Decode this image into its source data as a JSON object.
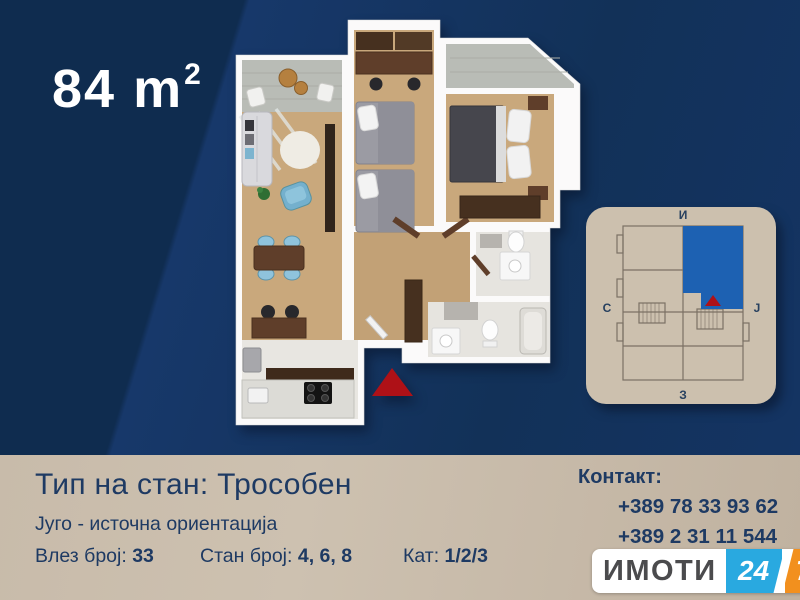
{
  "hero": {
    "area_value": "84",
    "area_unit": "m",
    "area_sup": "2"
  },
  "minimap": {
    "compass": {
      "top": "И",
      "left": "С",
      "right": "Ј",
      "bottom": "З"
    },
    "highlight_color": "#1d61b2",
    "marker_color": "#ae1117"
  },
  "floorplan": {
    "entrance_marker_color": "#ae1117"
  },
  "info": {
    "type_label": "Тип на стан:",
    "type_value": "Трособен",
    "orientation": "Југо - источна ориентација",
    "fields": [
      {
        "label": "Влез број:",
        "value": "33"
      },
      {
        "label": "Стан број:",
        "value": "4, 6, 8"
      },
      {
        "label": "Кат:",
        "value": "1/2/3"
      }
    ]
  },
  "contact": {
    "label": "Контакт:",
    "phones": [
      "+389 78 33 93 62",
      "+389 2 31 11 544"
    ]
  },
  "logo": {
    "name": "ИМОТИ",
    "hours": "24",
    "days": "7"
  },
  "colors": {
    "background_navy": "#12315a",
    "background_navy_dark": "#0f2c4f",
    "background_beige": "#c8bbaa",
    "text_navy": "#1e3a63",
    "logo_blue": "#29a9e0",
    "logo_orange": "#f2901e",
    "logo_gray": "#4b4b4d",
    "accent_red": "#ae1117",
    "wood_floor": "#c9a87c"
  }
}
